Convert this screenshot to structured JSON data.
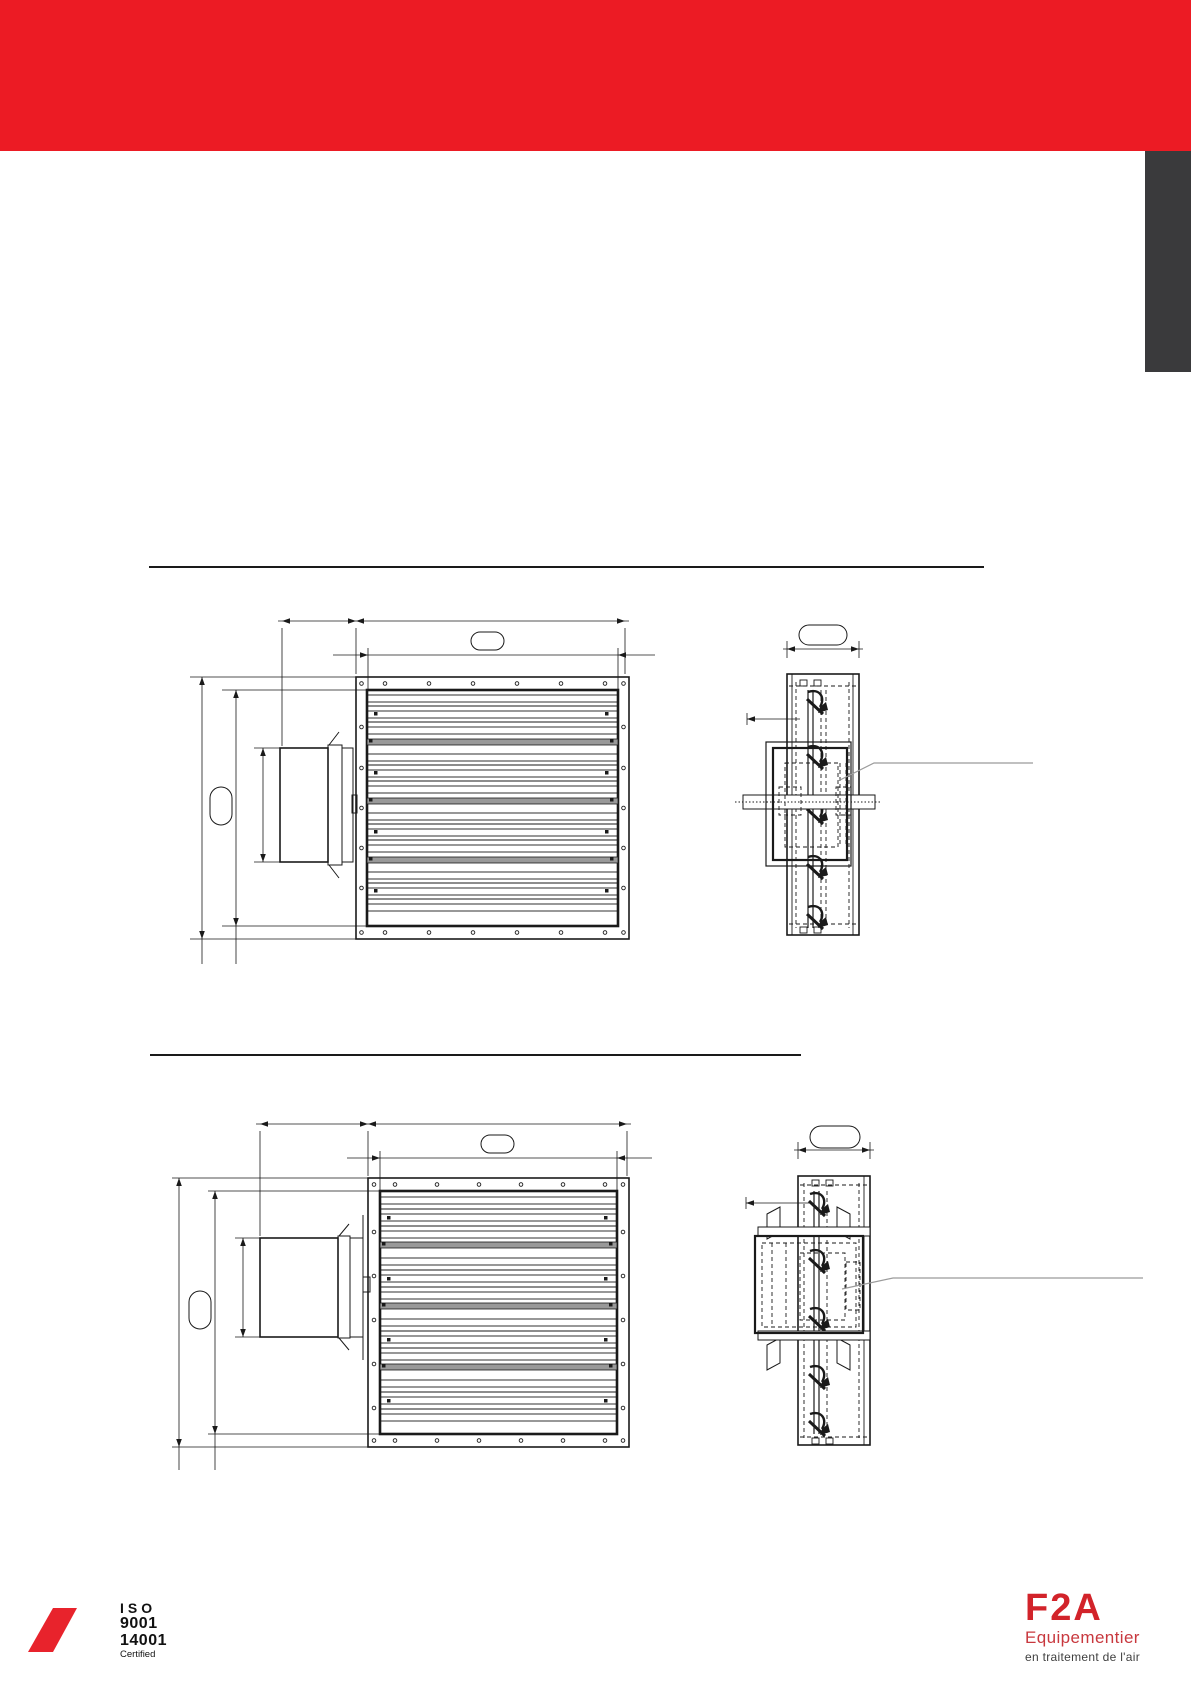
{
  "header": {
    "band_color": "#EC1B24"
  },
  "side_tab": {
    "color": "#3A3A3C"
  },
  "footer": {
    "certification": {
      "org": "ISO",
      "standard1": "9001",
      "standard2": "14001",
      "status": "Certified"
    },
    "brand": {
      "logo_text": "F2A",
      "tagline_line1": "Equipementier",
      "tagline_line2": "en traitement de l'air"
    },
    "colors": {
      "slash_red": "#E8232C",
      "logo_red": "#D2232A",
      "tagline_gray": "#3F3F3F"
    }
  },
  "colors": {
    "header_red": "#EC1B24",
    "tab_dark": "#3A3A3C",
    "drawing_ink": "#1a1a1a",
    "leader_gray": "#9B9B9B"
  }
}
